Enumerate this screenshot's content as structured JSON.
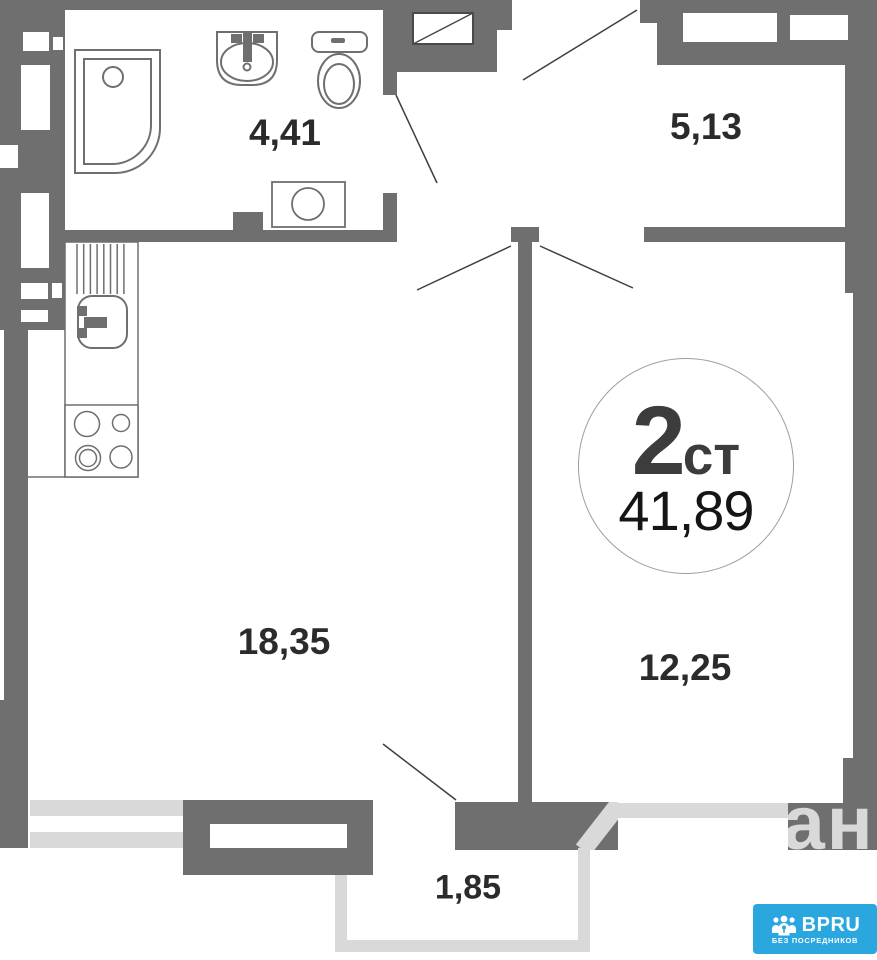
{
  "badge": {
    "rooms_count": "2",
    "type_suffix": "ст",
    "total_area": "41,89"
  },
  "areas": {
    "bathroom": "4,41",
    "hallway": "5,13",
    "living_kitchen": "18,35",
    "bedroom": "12,25",
    "balcony": "1,85"
  },
  "fixtures": [
    "bathtub",
    "bathroom-sink",
    "toilet",
    "washing-machine",
    "kitchen-sink",
    "drying-rack",
    "stove",
    "vent-shaft",
    "door-swing"
  ],
  "watermark": {
    "text": "циан"
  },
  "logo": {
    "brand": "BPRU",
    "tagline": "БЕЗ ПОСРЕДНИКОВ"
  },
  "colors": {
    "wall": "#6f6f6f",
    "balcony_outline": "#d9d9d9",
    "label_text": "#2b2b2b",
    "badge_number": "#3c3c3c",
    "logo_bg": "#2ba7e0"
  }
}
